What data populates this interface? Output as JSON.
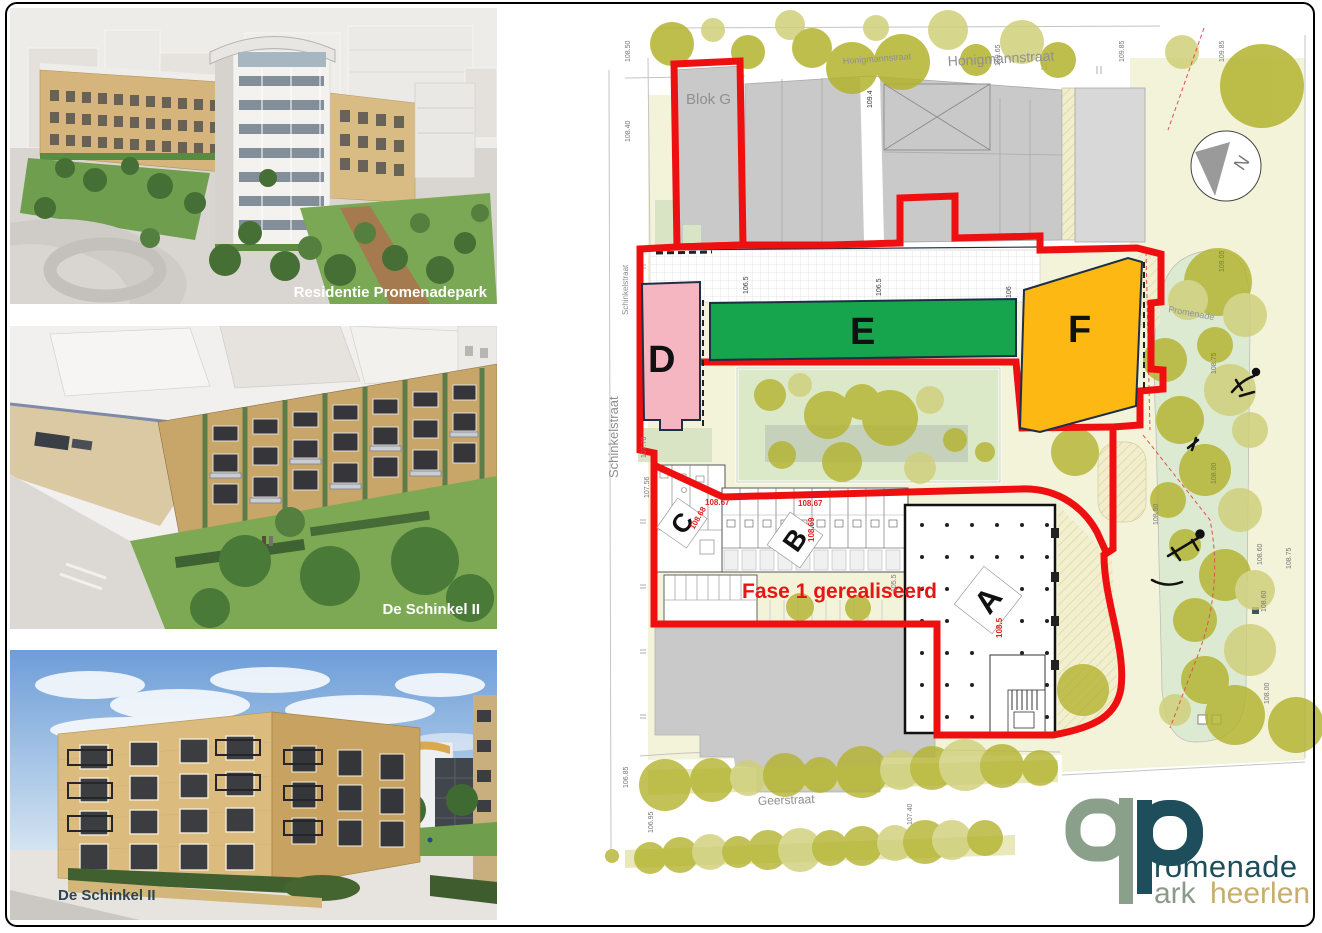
{
  "photos": [
    {
      "caption": "Residentie Promenadepark"
    },
    {
      "caption": "De Schinkel II"
    },
    {
      "caption": "De Schinkel II"
    }
  ],
  "map": {
    "street_labels": {
      "honigmann_small": "Honigmannstraat",
      "honigmann_large": "Honigmannstraat",
      "schinkel_small": "Schinkelstraat",
      "schinkel_large": "Schinkelstraat",
      "geerstraat": "Geerstraat",
      "promenade": "Promenade"
    },
    "block_labels": {
      "g": "Blok G",
      "d": "D",
      "e": "E",
      "f": "F",
      "a": "A",
      "b": "B",
      "c": "C"
    },
    "annotations": {
      "fase": "Fase 1 gerealiseerd",
      "compass": "N"
    },
    "elevations": {
      "e1": "108.50",
      "e2": "108.40",
      "e3": "109.4",
      "e4": "109.65",
      "e5": "109.85",
      "e6": "109.85",
      "e7": "106.5",
      "e8": "106.5",
      "e9": "106",
      "e10": "107.70",
      "e11": "107.56",
      "e12": "108.67",
      "e13": "108.67",
      "e14": "108.69",
      "e15": "108.68",
      "e16": "105.5",
      "e17": "108.5",
      "e18": "106.85",
      "e19": "106.95",
      "e20": "107.40",
      "e21": "109.05",
      "e22": "108.75",
      "e23": "108.00",
      "e24": "108.50",
      "e25": "108.60",
      "e26": "108.75",
      "e27": "108.60",
      "e28": "108.00"
    },
    "colors": {
      "site_boundary_red": "#ee1010",
      "block_d_pink": "#f5b6c1",
      "block_e_green": "#16a44c",
      "block_f_orange": "#fdb814",
      "tree_olive": "#b3b32f",
      "parcel_cream": "#f3f3da",
      "park_green": "#dcead2",
      "building_gray": "#c9c9c9"
    }
  },
  "logo": {
    "wordmark_line1": "romenade",
    "wordmark_line2a": "ark",
    "wordmark_line2b": "heerlen",
    "glyph_sage": "#8ba08b",
    "glyph_teal": "#1e4e5c",
    "gold": "#c8ae6e"
  }
}
